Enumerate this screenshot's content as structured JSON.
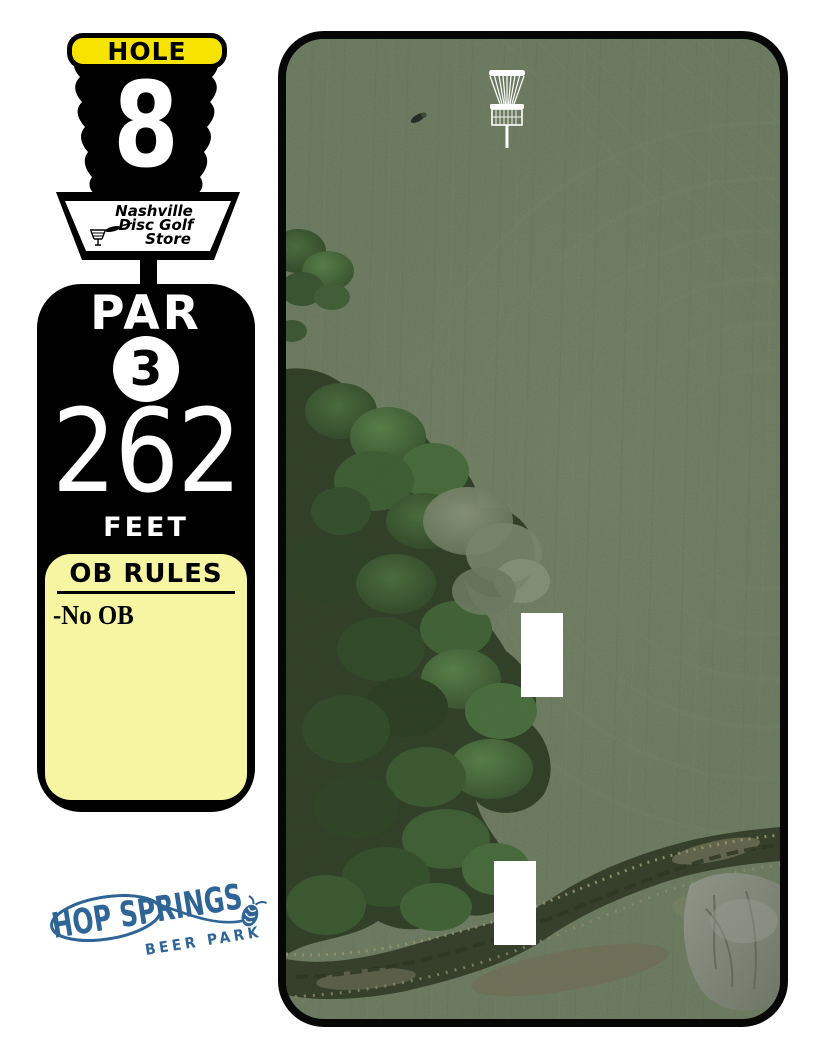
{
  "hole_sign": {
    "hole_label": "HOLE",
    "hole_number": "8",
    "sponsor_line1": "Nashville",
    "sponsor_line2": "Disc Golf",
    "sponsor_line3": "Store",
    "par_label": "PAR",
    "par_value": "3",
    "distance": "262",
    "distance_unit": "FEET",
    "ob_title": "OB RULES",
    "ob_rules": [
      "-No OB"
    ]
  },
  "footer": {
    "brand_name": "HOP SPRINGS",
    "brand_subtitle": "BEER PARK"
  },
  "map": {
    "marker": "disc-golf-basket-icon",
    "tee_pad_count": 2
  },
  "colors": {
    "sign_yellow": "#F6E400",
    "ob_panel_yellow": "#F6F6A2",
    "panel_black": "#000000",
    "brand_blue": "#2E6496",
    "grass_green": "#51604A",
    "tee_pad_white": "#FFFFFF"
  }
}
